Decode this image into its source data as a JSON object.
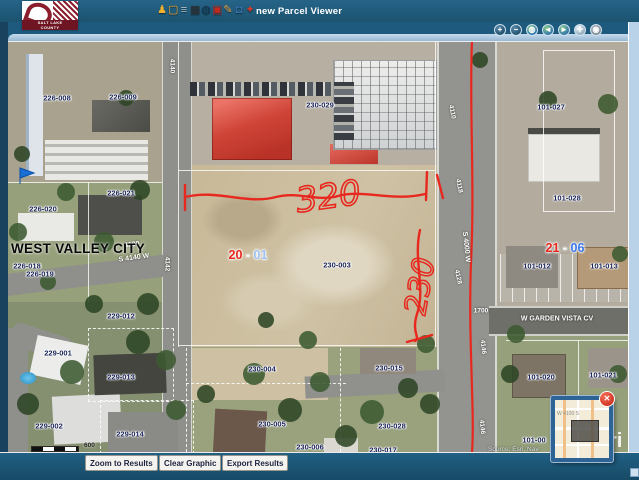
{
  "header": {
    "logo": {
      "line1": "SALT LAKE",
      "line2": "COUNTY"
    },
    "title": "new Parcel Viewer",
    "toolbar_icons": [
      {
        "name": "identify-person",
        "glyph": "♟",
        "color": "#f2b02f"
      },
      {
        "name": "select-box",
        "glyph": "▢",
        "color": "#f2a21f"
      },
      {
        "name": "layers",
        "glyph": "≡",
        "color": "#b6c1c9"
      },
      {
        "name": "print",
        "glyph": "▦",
        "color": "#2e2e2e"
      },
      {
        "name": "globe-tool",
        "glyph": "◍",
        "color": "#14344e"
      },
      {
        "name": "export-pdf",
        "glyph": "▣",
        "color": "#c42b1c"
      },
      {
        "name": "draw-pencil",
        "glyph": "✎",
        "color": "#e8a33d"
      },
      {
        "name": "security-lock",
        "glyph": "◘",
        "color": "#3a6fb0"
      },
      {
        "name": "shared-links",
        "glyph": "✦",
        "color": "#d23b2a"
      }
    ]
  },
  "nav": {
    "buttons": [
      {
        "name": "zoom-in",
        "glyph": "+",
        "bg": "radial-gradient(circle at 35% 30%,#5d8cab,#1f4d6b 75%)"
      },
      {
        "name": "zoom-out",
        "glyph": "−",
        "bg": "radial-gradient(circle at 35% 30%,#5d8cab,#1f4d6b 75%)"
      },
      {
        "name": "full-extent",
        "glyph": "◍",
        "bg": "radial-gradient(circle at 35% 30%,#8fd08a,#2a6fae 75%)"
      },
      {
        "name": "previous-extent",
        "glyph": "◄",
        "bg": "radial-gradient(circle at 35% 30%,#8fd08a,#2a6fae 75%)"
      },
      {
        "name": "next-extent",
        "glyph": "►",
        "bg": "radial-gradient(circle at 35% 30%,#8fd08a,#2a6fae 75%)"
      },
      {
        "name": "pan",
        "glyph": "✛",
        "bg": "radial-gradient(circle at 35% 30%,#eef4f8,#8fa9bc 75%)"
      },
      {
        "name": "identify-tool",
        "glyph": "◉",
        "bg": "radial-gradient(circle at 35% 30%,#aeb9c0,#798791 75%)"
      }
    ]
  },
  "map": {
    "city_label": "WEST VALLEY CITY",
    "parcel_labels": [
      {
        "t": "226-008",
        "x": 57,
        "y": 98
      },
      {
        "t": "226-009",
        "x": 123,
        "y": 97
      },
      {
        "t": "226-020",
        "x": 43,
        "y": 209
      },
      {
        "t": "226-021",
        "x": 121,
        "y": 193
      },
      {
        "t": "226-018",
        "x": 27,
        "y": 266
      },
      {
        "t": "226-019",
        "x": 40,
        "y": 274
      },
      {
        "t": "229-012",
        "x": 121,
        "y": 316
      },
      {
        "t": "229-001",
        "x": 58,
        "y": 353
      },
      {
        "t": "229-013",
        "x": 121,
        "y": 377
      },
      {
        "t": "229-002",
        "x": 49,
        "y": 426
      },
      {
        "t": "229-014",
        "x": 130,
        "y": 434
      },
      {
        "t": "229-003",
        "x": 64,
        "y": 450
      },
      {
        "t": "230-029",
        "x": 320,
        "y": 105
      },
      {
        "t": "230-003",
        "x": 337,
        "y": 265
      },
      {
        "t": "230-004",
        "x": 262,
        "y": 369
      },
      {
        "t": "230-015",
        "x": 389,
        "y": 368
      },
      {
        "t": "230-005",
        "x": 272,
        "y": 424
      },
      {
        "t": "230-028",
        "x": 392,
        "y": 426
      },
      {
        "t": "230-006",
        "x": 310,
        "y": 447
      },
      {
        "t": "230-017",
        "x": 383,
        "y": 450
      },
      {
        "t": "101-027",
        "x": 551,
        "y": 107
      },
      {
        "t": "101-028",
        "x": 567,
        "y": 198
      },
      {
        "t": "101-012",
        "x": 537,
        "y": 266
      },
      {
        "t": "101-013",
        "x": 604,
        "y": 266
      },
      {
        "t": "101-020",
        "x": 541,
        "y": 377
      },
      {
        "t": "101-021",
        "x": 603,
        "y": 375
      },
      {
        "t": "101-00",
        "x": 534,
        "y": 440
      }
    ],
    "highlight_labels": [
      {
        "red": "20",
        "sep": " - ",
        "blue": "01",
        "blue_hex": "#9fc2f5",
        "x": 248,
        "y": 255
      },
      {
        "red": "21",
        "sep": " - ",
        "blue": "06",
        "blue_hex": "#3b77ee",
        "x": 565,
        "y": 248
      }
    ],
    "street_labels": [
      {
        "t": "4100",
        "x": 132,
        "y": 245,
        "r": -8,
        "s": 7
      },
      {
        "t": "S 4140 W",
        "x": 134,
        "y": 258,
        "r": -8,
        "s": 7
      },
      {
        "t": "4140",
        "x": 172,
        "y": 66,
        "r": 90,
        "s": 6.5
      },
      {
        "t": "4142",
        "x": 167,
        "y": 264,
        "r": 90,
        "s": 6.5
      },
      {
        "t": "4110",
        "x": 452,
        "y": 112,
        "r": 78,
        "s": 6.5
      },
      {
        "t": "4118",
        "x": 459,
        "y": 186,
        "r": 78,
        "s": 6.5
      },
      {
        "t": "S 4000 W",
        "x": 466,
        "y": 247,
        "r": 84,
        "s": 7
      },
      {
        "t": "4128",
        "x": 458,
        "y": 277,
        "r": 78,
        "s": 6.5
      },
      {
        "t": "1700",
        "x": 481,
        "y": 311,
        "r": 0,
        "s": 6.5
      },
      {
        "t": "4146",
        "x": 483,
        "y": 347,
        "r": 84,
        "s": 6.5
      },
      {
        "t": "4146",
        "x": 482,
        "y": 427,
        "r": 84,
        "s": 6.5
      },
      {
        "t": "W GARDEN VISTA CV",
        "x": 557,
        "y": 319,
        "r": 0,
        "s": 7
      }
    ],
    "annotations": {
      "width": "320",
      "height": "230",
      "color": "#e8281e"
    },
    "scale": {
      "label": "600"
    },
    "attribution": "Source: Esri, Nav",
    "esri_partial": "ri"
  },
  "overview": {
    "street_label": "W 4100 S",
    "close_glyph": "✕"
  },
  "footer": {
    "buttons": [
      {
        "name": "zoom-to-results-button",
        "label": "Zoom to Results",
        "x": 85
      },
      {
        "name": "clear-graphic-button",
        "label": "Clear Graphic",
        "x": 159
      },
      {
        "name": "export-results-button",
        "label": "Export Results",
        "x": 222
      }
    ]
  }
}
